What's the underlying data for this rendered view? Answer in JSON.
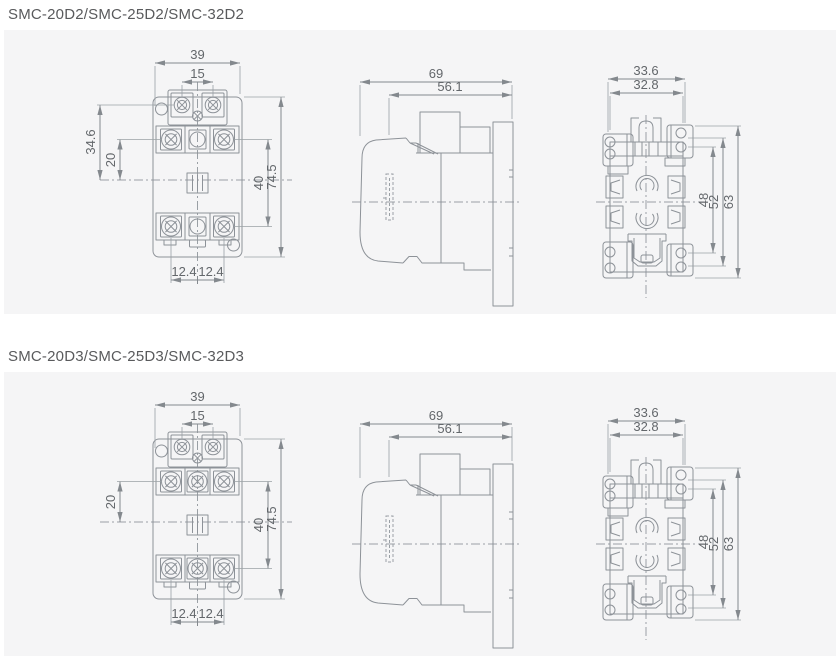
{
  "page": {
    "background": "#ffffff",
    "panel_background": "#f5f5f6",
    "line_color": "#8d9298",
    "dim_text_color": "#63676b",
    "title_color": "#595a5c"
  },
  "sections": [
    {
      "id": "d2",
      "title": "SMC-20D2/SMC-25D2/SMC-32D2",
      "front_view": {
        "overall_width": "39",
        "coil_terminal_pitch": "15",
        "coil_center_height": "34.6",
        "main_center_height": "20",
        "terminal_row_spacing": "40",
        "overall_height": "74.5",
        "bottom_pitch_left": "12.4",
        "bottom_pitch_right": "12.4"
      },
      "side_view": {
        "overall_depth": "69",
        "body_depth": "56.1"
      },
      "rear_view": {
        "mounting_width_outer": "33.6",
        "mounting_width_inner": "32.8",
        "hole_spacing_inner": "48",
        "hole_spacing_outer": "52",
        "overall_height": "63"
      }
    },
    {
      "id": "d3",
      "title": "SMC-20D3/SMC-25D3/SMC-32D3",
      "front_view": {
        "overall_width": "39",
        "coil_terminal_pitch": "15",
        "main_center_height": "20",
        "terminal_row_spacing": "40",
        "overall_height": "74.5",
        "bottom_pitch_left": "12.4",
        "bottom_pitch_right": "12.4"
      },
      "side_view": {
        "overall_depth": "69",
        "body_depth": "56.1"
      },
      "rear_view": {
        "mounting_width_outer": "33.6",
        "mounting_width_inner": "32.8",
        "hole_spacing_inner": "48",
        "hole_spacing_outer": "52",
        "overall_height": "63"
      }
    }
  ]
}
